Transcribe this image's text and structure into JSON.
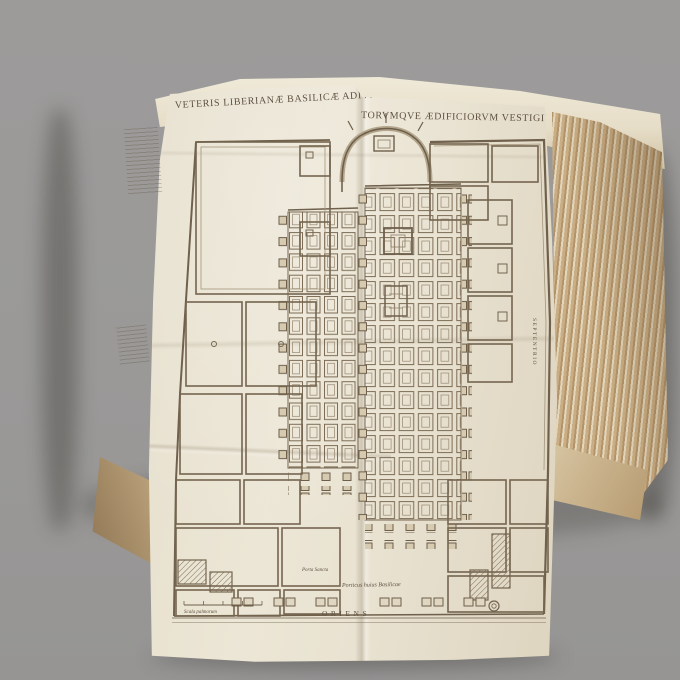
{
  "photo": {
    "background_color": "#9b9a99",
    "paper_color": "#e9e2d2",
    "page_edge_color": "#c3a87e",
    "ink_color": "#6e5f4b"
  },
  "plate": {
    "title_left": "VETERIS LIBERIANÆ BASILICÆ ADIVNC",
    "title_right": "TORVMQVE ÆDIFICIORVM VESTIGIVM",
    "folio_number": "15",
    "labels": {
      "porticus_caption": "Porticus huius Basilicae",
      "oriens": "ORIENS",
      "septentrio": "SEPTENTRIO",
      "porta_sancta": "Porta Sancta",
      "scale_bar": "Scala palmorum"
    }
  }
}
